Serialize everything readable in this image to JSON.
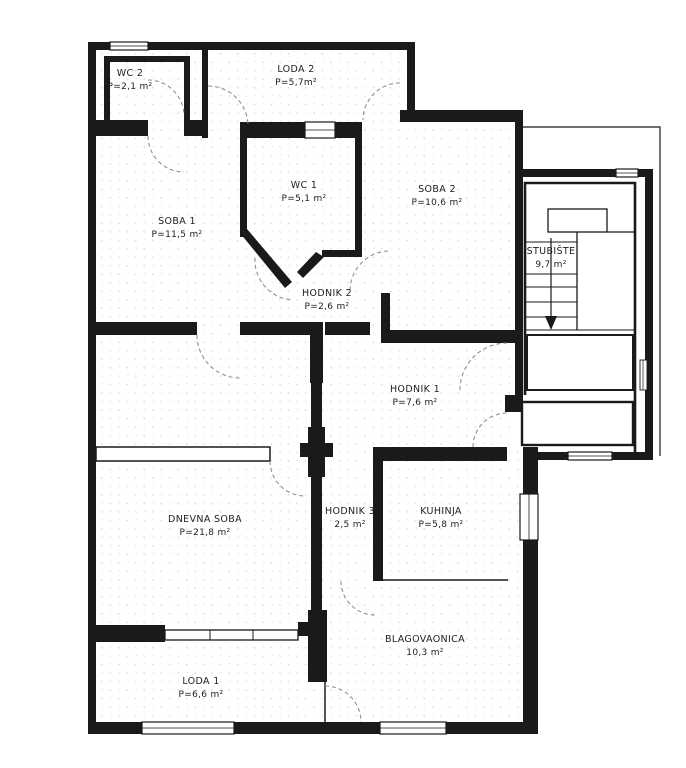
{
  "floor_plan": {
    "rooms": [
      {
        "id": "wc-2",
        "name": "WC 2",
        "area": "P=2,1 m²"
      },
      {
        "id": "loda-2",
        "name": "LODA 2",
        "area": "P=5,7m²"
      },
      {
        "id": "wc-1",
        "name": "WC 1",
        "area": "P=5,1 m²"
      },
      {
        "id": "soba-2",
        "name": "SOBA 2",
        "area": "P=10,6 m²"
      },
      {
        "id": "soba-1",
        "name": "SOBA 1",
        "area": "P=11,5 m²"
      },
      {
        "id": "hodnik-2",
        "name": "HODNIK 2",
        "area": "P=2,6 m²"
      },
      {
        "id": "stubiste",
        "name": "STUBIŠTE",
        "area": "9,7 m²"
      },
      {
        "id": "hodnik-1",
        "name": "HODNIK 1",
        "area": "P=7,6 m²"
      },
      {
        "id": "dnevna-soba",
        "name": "DNEVNA SOBA",
        "area": "P=21,8 m²"
      },
      {
        "id": "hodnik-3",
        "name": "HODNIK 3",
        "area": "2,5 m²"
      },
      {
        "id": "kuhinja",
        "name": "KUHINJA",
        "area": "P=5,8 m²"
      },
      {
        "id": "blagovaonica",
        "name": "BLAGOVAONICA",
        "area": "10,3 m²"
      },
      {
        "id": "loda-1",
        "name": "LODA 1",
        "area": "P=6,6 m²"
      }
    ],
    "colors": {
      "wall": "#1a1a1a",
      "door_arc": "#8f8f8f",
      "floor_dot": "#9a9a9a"
    }
  }
}
